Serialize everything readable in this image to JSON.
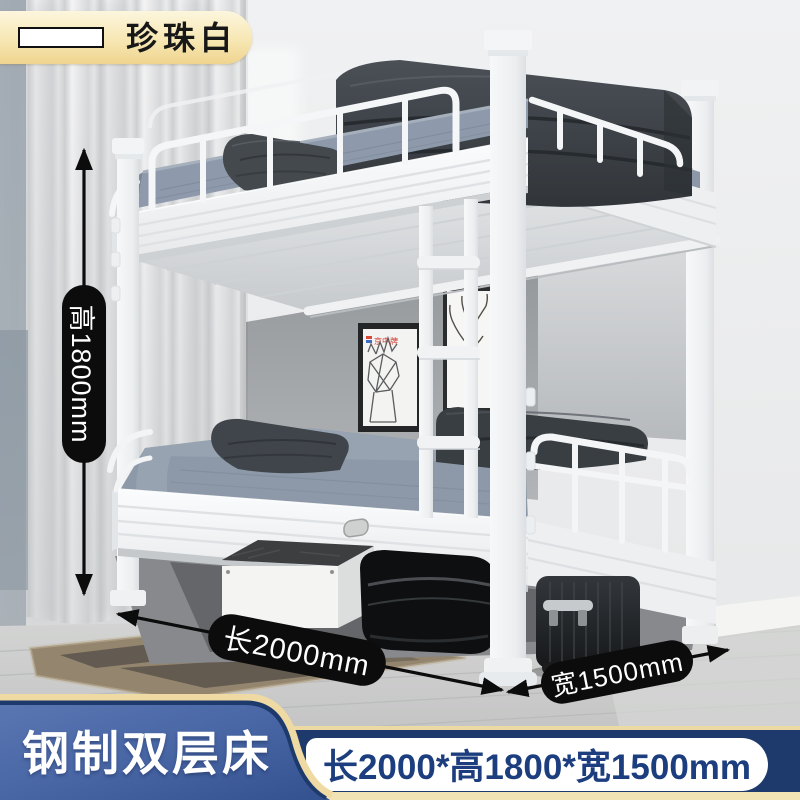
{
  "color_badge": {
    "label": "珍珠白",
    "swatch_color": "#ffffff"
  },
  "dimensions": {
    "height": "高1800mm",
    "length": "长2000mm",
    "width": "宽1500mm"
  },
  "footer": {
    "product_name": "钢制双层床",
    "size_spec": "长2000*高1800*宽1500mm"
  },
  "scene": {
    "wall_art_brand": "京中牌"
  },
  "colors": {
    "badge_gold": "#f5e2a8",
    "annotation_black": "#0c0c0c",
    "panel_blue": "#4a67a6",
    "band_navy": "#1e3a6c",
    "gold_trim": "#eedaa2",
    "spec_text_blue": "#1c3e7e",
    "bed_white": "#f6f7f8",
    "mattress_blue_gray": "#8d99a8"
  }
}
